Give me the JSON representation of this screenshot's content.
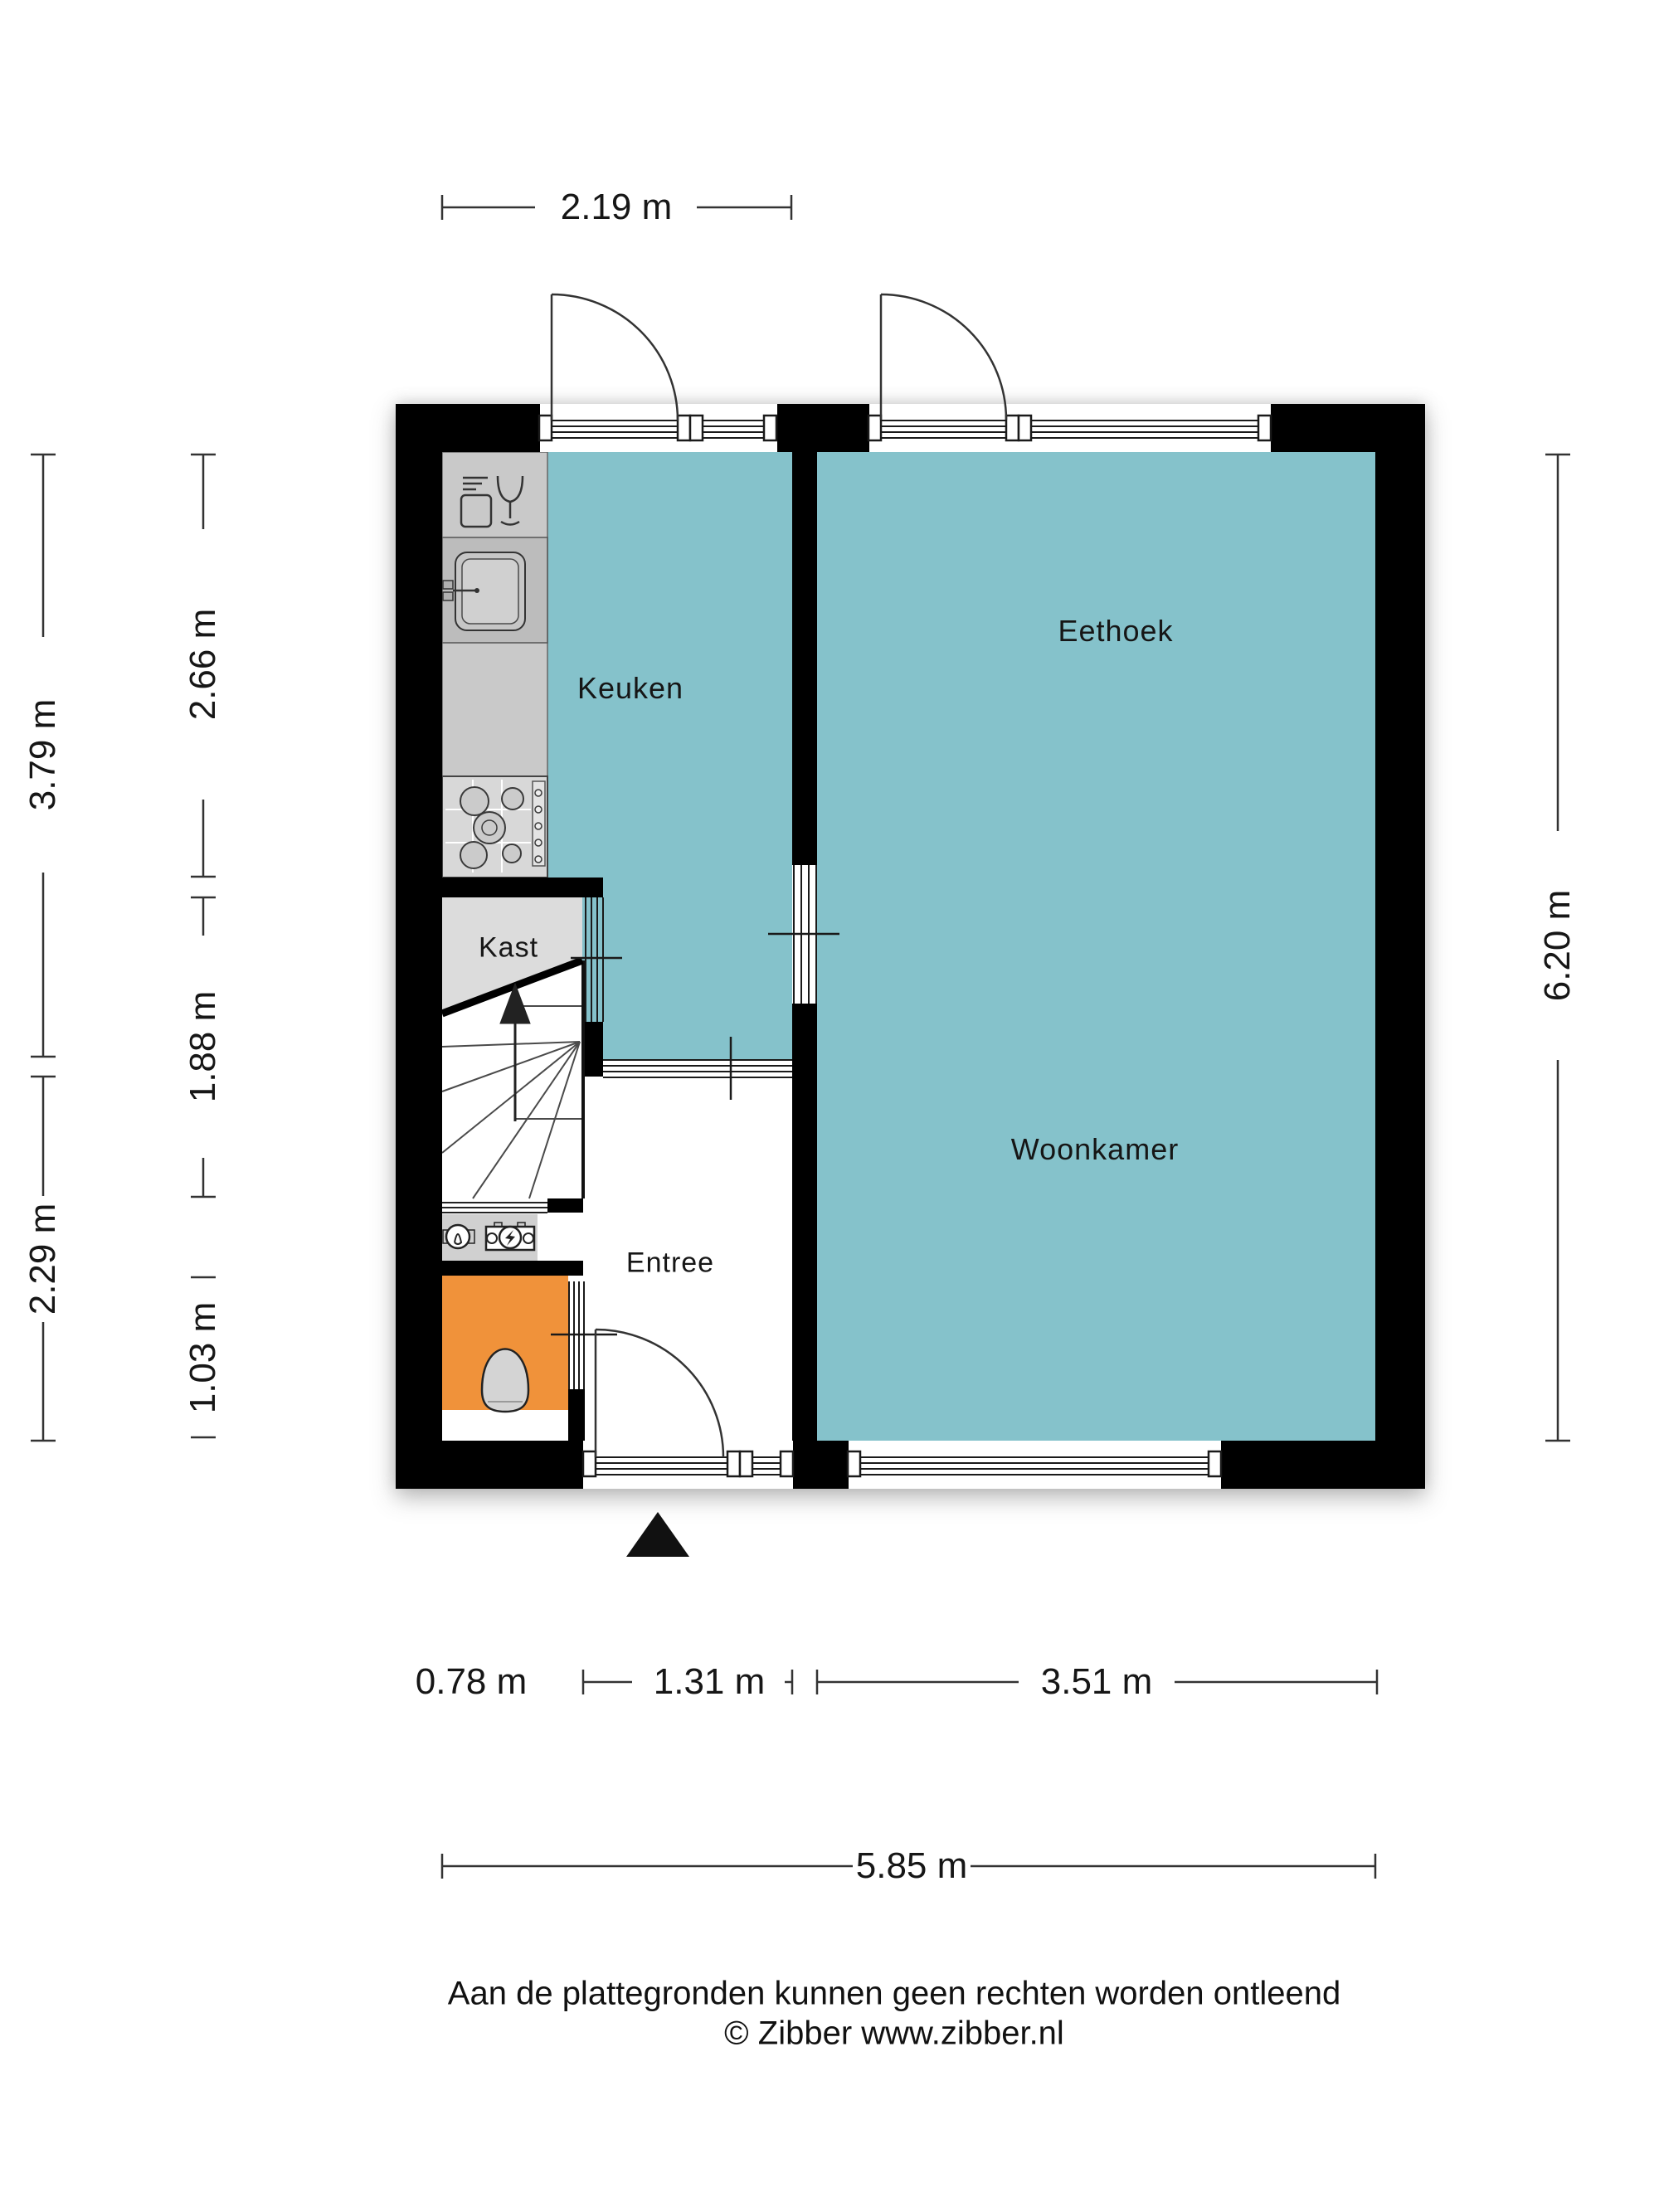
{
  "title": "Plattegrond begane grond",
  "rooms": {
    "keuken": "Keuken",
    "eethoek": "Eethoek",
    "woonkamer": "Woonkamer",
    "kast": "Kast",
    "entree": "Entree"
  },
  "dimensions": {
    "top_width": "2.19 m",
    "bottom_segments": [
      "0.78 m",
      "1.31 m",
      "3.51 m"
    ],
    "bottom_total": "5.85 m",
    "left_outer": [
      "3.79 m",
      "2.29 m"
    ],
    "left_inner": [
      "2.66 m",
      "1.88 m",
      "1.03 m"
    ],
    "right_total": "6.20 m"
  },
  "icons": {
    "dishwasher": "dishwasher-icon",
    "sink": "sink-icon",
    "stove": "stove-icon",
    "lamp": "lamp-icon",
    "electric_meter": "electric-meter-icon",
    "toilet": "toilet-icon",
    "stairs_arrow": "stairs-up-arrow-icon",
    "entrance_marker": "entrance-arrow-icon"
  },
  "colors": {
    "room_fill": "#85c2cb",
    "toilet_fill": "#f0923a",
    "wall": "#000000",
    "counter": "#c9c9c9",
    "kast": "#dcdcdc"
  },
  "footer": {
    "line1": "Aan de plattegronden kunnen geen rechten worden ontleend",
    "line2": "© Zibber www.zibber.nl"
  }
}
